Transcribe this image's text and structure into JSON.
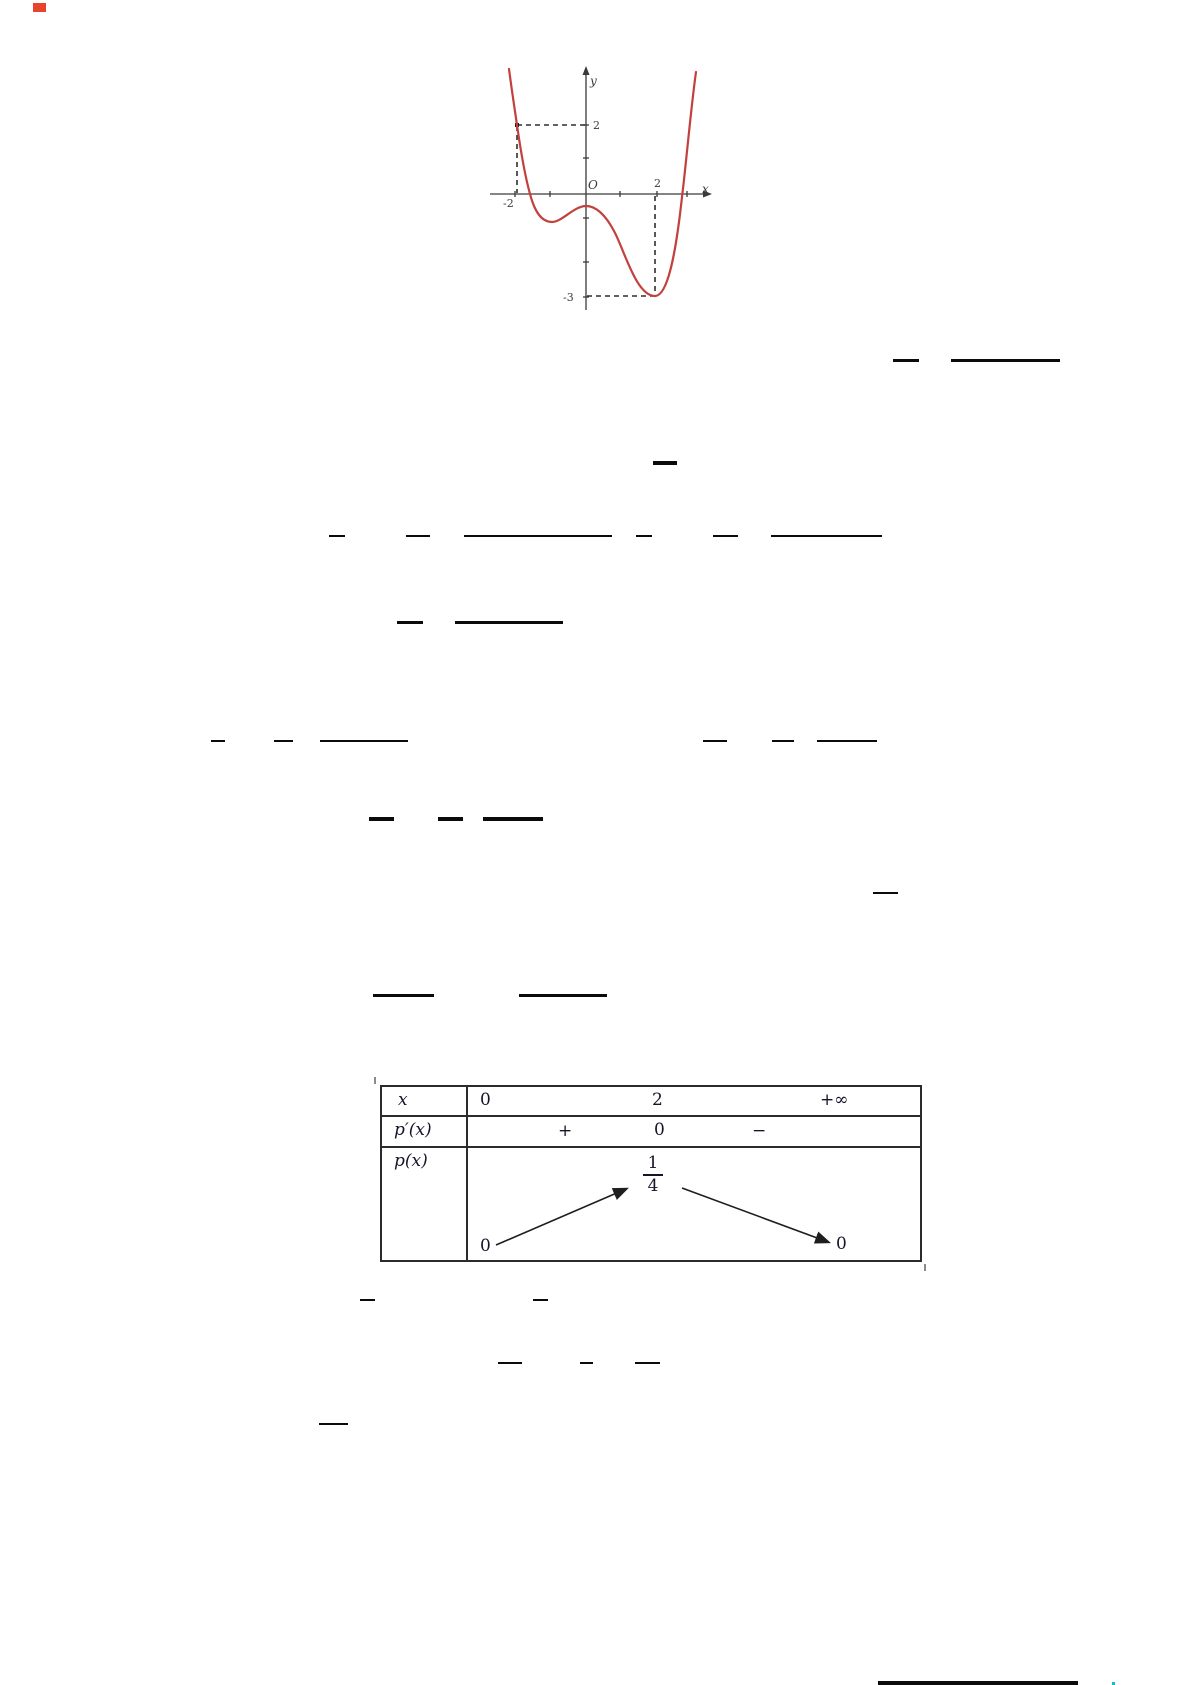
{
  "page_kind": "scanned math worksheet page (text not rendered, only math fraction bars, a curve graph and a variation table visible)",
  "graph": {
    "y_axis_label": "y",
    "x_axis_label": "x",
    "origin_label": "O",
    "label_y_2": "2",
    "label_x_minus2": "-2",
    "label_x_2": "2",
    "label_y_minus3": "-3",
    "curve_color": "#c2413d",
    "dash_color": "#2e2e2e"
  },
  "chart_data": [
    {
      "type": "line",
      "title": "",
      "xlabel": "x",
      "ylabel": "y",
      "description": "Red quartic-style curve: decreasing steeply through (-2,2), crossing x-axis near x=-1.9, local minimum near (-1.2,-0.9), local maximum near (0,-0.4), global minimum at (2,-3), rising steeply crossing x-axis near x=2.8",
      "marked_points": [
        {
          "x": -2,
          "y": 2
        },
        {
          "x": 2,
          "y": -3
        }
      ],
      "x_ticks": [
        -2,
        -1,
        1,
        2,
        3
      ],
      "y_ticks": [
        -3,
        -2,
        -1,
        1,
        2
      ],
      "dashed_guides": [
        "horizontal from (-2,2) to y-axis",
        "vertical from (-2,2) to x-axis",
        "vertical from (2,0) down to (2,-3)",
        "horizontal from y-axis to (2,-3)"
      ],
      "grid": false,
      "legend": "none"
    },
    {
      "type": "table",
      "title": "variation table of p",
      "columns": [
        "x",
        "0",
        "2",
        "+∞"
      ],
      "rows": [
        [
          "p′(x)",
          "+",
          "0",
          "−"
        ],
        [
          "p(x)",
          "0 ↗ 1/4 ↘ 0"
        ]
      ]
    }
  ],
  "vtable": {
    "var_label": "x",
    "x_values": [
      "0",
      "2",
      "+∞"
    ],
    "deriv_label": "p′(x)",
    "deriv_signs": [
      "+",
      "0",
      "−"
    ],
    "func_label": "p(x)",
    "variation": {
      "start": "0",
      "peak_numerator": "1",
      "peak_denominator": "4",
      "end": "0"
    }
  },
  "fraction_bars": [
    {
      "x": 893,
      "y": 359,
      "w": 26,
      "h": 3
    },
    {
      "x": 951,
      "y": 359,
      "w": 109,
      "h": 3
    },
    {
      "x": 653,
      "y": 461,
      "w": 24,
      "h": 4
    },
    {
      "x": 329,
      "y": 535,
      "w": 16,
      "h": 2
    },
    {
      "x": 406,
      "y": 535,
      "w": 24,
      "h": 2
    },
    {
      "x": 464,
      "y": 535,
      "w": 148,
      "h": 2
    },
    {
      "x": 636,
      "y": 535,
      "w": 16,
      "h": 2
    },
    {
      "x": 713,
      "y": 535,
      "w": 25,
      "h": 2
    },
    {
      "x": 771,
      "y": 535,
      "w": 111,
      "h": 2
    },
    {
      "x": 397,
      "y": 621,
      "w": 26,
      "h": 3
    },
    {
      "x": 455,
      "y": 621,
      "w": 108,
      "h": 3
    },
    {
      "x": 211,
      "y": 740,
      "w": 14,
      "h": 2
    },
    {
      "x": 274,
      "y": 740,
      "w": 19,
      "h": 2
    },
    {
      "x": 320,
      "y": 740,
      "w": 88,
      "h": 2
    },
    {
      "x": 703,
      "y": 740,
      "w": 24,
      "h": 2
    },
    {
      "x": 772,
      "y": 740,
      "w": 22,
      "h": 2
    },
    {
      "x": 817,
      "y": 740,
      "w": 60,
      "h": 2
    },
    {
      "x": 369,
      "y": 817,
      "w": 25,
      "h": 4
    },
    {
      "x": 438,
      "y": 817,
      "w": 25,
      "h": 4
    },
    {
      "x": 483,
      "y": 817,
      "w": 60,
      "h": 4
    },
    {
      "x": 873,
      "y": 892,
      "w": 25,
      "h": 2
    },
    {
      "x": 373,
      "y": 994,
      "w": 61,
      "h": 3
    },
    {
      "x": 519,
      "y": 994,
      "w": 88,
      "h": 3
    },
    {
      "x": 360,
      "y": 1299,
      "w": 15,
      "h": 2
    },
    {
      "x": 533,
      "y": 1299,
      "w": 15,
      "h": 2
    },
    {
      "x": 498,
      "y": 1362,
      "w": 24,
      "h": 2
    },
    {
      "x": 580,
      "y": 1362,
      "w": 13,
      "h": 2
    },
    {
      "x": 635,
      "y": 1362,
      "w": 25,
      "h": 2
    },
    {
      "x": 319,
      "y": 1423,
      "w": 29,
      "h": 2
    }
  ],
  "artifacts": {
    "top_left_mark": {
      "x": 33,
      "y": 3,
      "w": 13,
      "h": 9,
      "color": "#e8432d"
    },
    "bottom_rule": {
      "x": 878,
      "y": 1681,
      "w": 200,
      "h": 4,
      "color": "#0b0b0b"
    },
    "bottom_cyan_dot": {
      "x": 1112,
      "y": 1682,
      "w": 3,
      "h": 3,
      "color": "#00c6c6"
    },
    "table_tick_topleft": {
      "x": 374,
      "y": 1077,
      "w": 2,
      "h": 7,
      "color": "#8a8a8a"
    },
    "table_tick_bottomright": {
      "x": 924,
      "y": 1264,
      "w": 2,
      "h": 7,
      "color": "#8a8a8a"
    }
  }
}
